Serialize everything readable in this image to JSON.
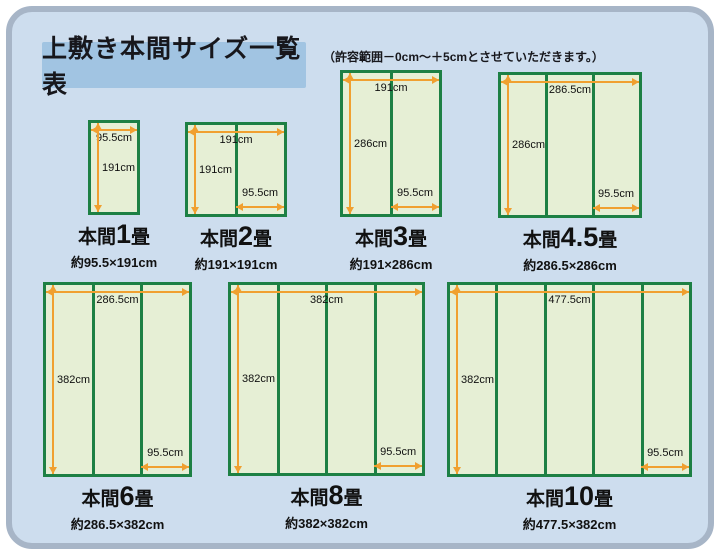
{
  "header": {
    "title": "上敷き本間サイズ一覧表",
    "note": "（許容範囲－0cm～＋5cmとさせていただきます。）"
  },
  "colors": {
    "panel_bg": "#cdddee",
    "panel_border": "#a7b5c7",
    "title_bg": "#a1c4e2",
    "mat_fill": "#e6efd5",
    "mat_green": "#1d8044",
    "arrow_orange": "#f0a030"
  },
  "diagrams": [
    {
      "caption_prefix": "本間",
      "caption_num": "1",
      "caption_suffix": "畳",
      "size": "約95.5×191cm",
      "top": "95.5cm",
      "left": "191cm"
    },
    {
      "caption_prefix": "本間",
      "caption_num": "2",
      "caption_suffix": "畳",
      "size": "約191×191cm",
      "top": "191cm",
      "left": "191cm",
      "bottom": "95.5cm"
    },
    {
      "caption_prefix": "本間",
      "caption_num": "3",
      "caption_suffix": "畳",
      "size": "約191×286cm",
      "top": "191cm",
      "left": "286cm",
      "bottom": "95.5cm"
    },
    {
      "caption_prefix": "本間",
      "caption_num": "4.5",
      "caption_suffix": "畳",
      "size": "約286.5×286cm",
      "top": "286.5cm",
      "left": "286cm",
      "bottom": "95.5cm"
    },
    {
      "caption_prefix": "本間",
      "caption_num": "6",
      "caption_suffix": "畳",
      "size": "約286.5×382cm",
      "top": "286.5cm",
      "left": "382cm",
      "bottom": "95.5cm"
    },
    {
      "caption_prefix": "本間",
      "caption_num": "8",
      "caption_suffix": "畳",
      "size": "約382×382cm",
      "top": "382cm",
      "left": "382cm",
      "bottom": "95.5cm"
    },
    {
      "caption_prefix": "本間",
      "caption_num": "10",
      "caption_suffix": "畳",
      "size": "約477.5×382cm",
      "top": "477.5cm",
      "left": "382cm",
      "bottom": "95.5cm"
    }
  ]
}
